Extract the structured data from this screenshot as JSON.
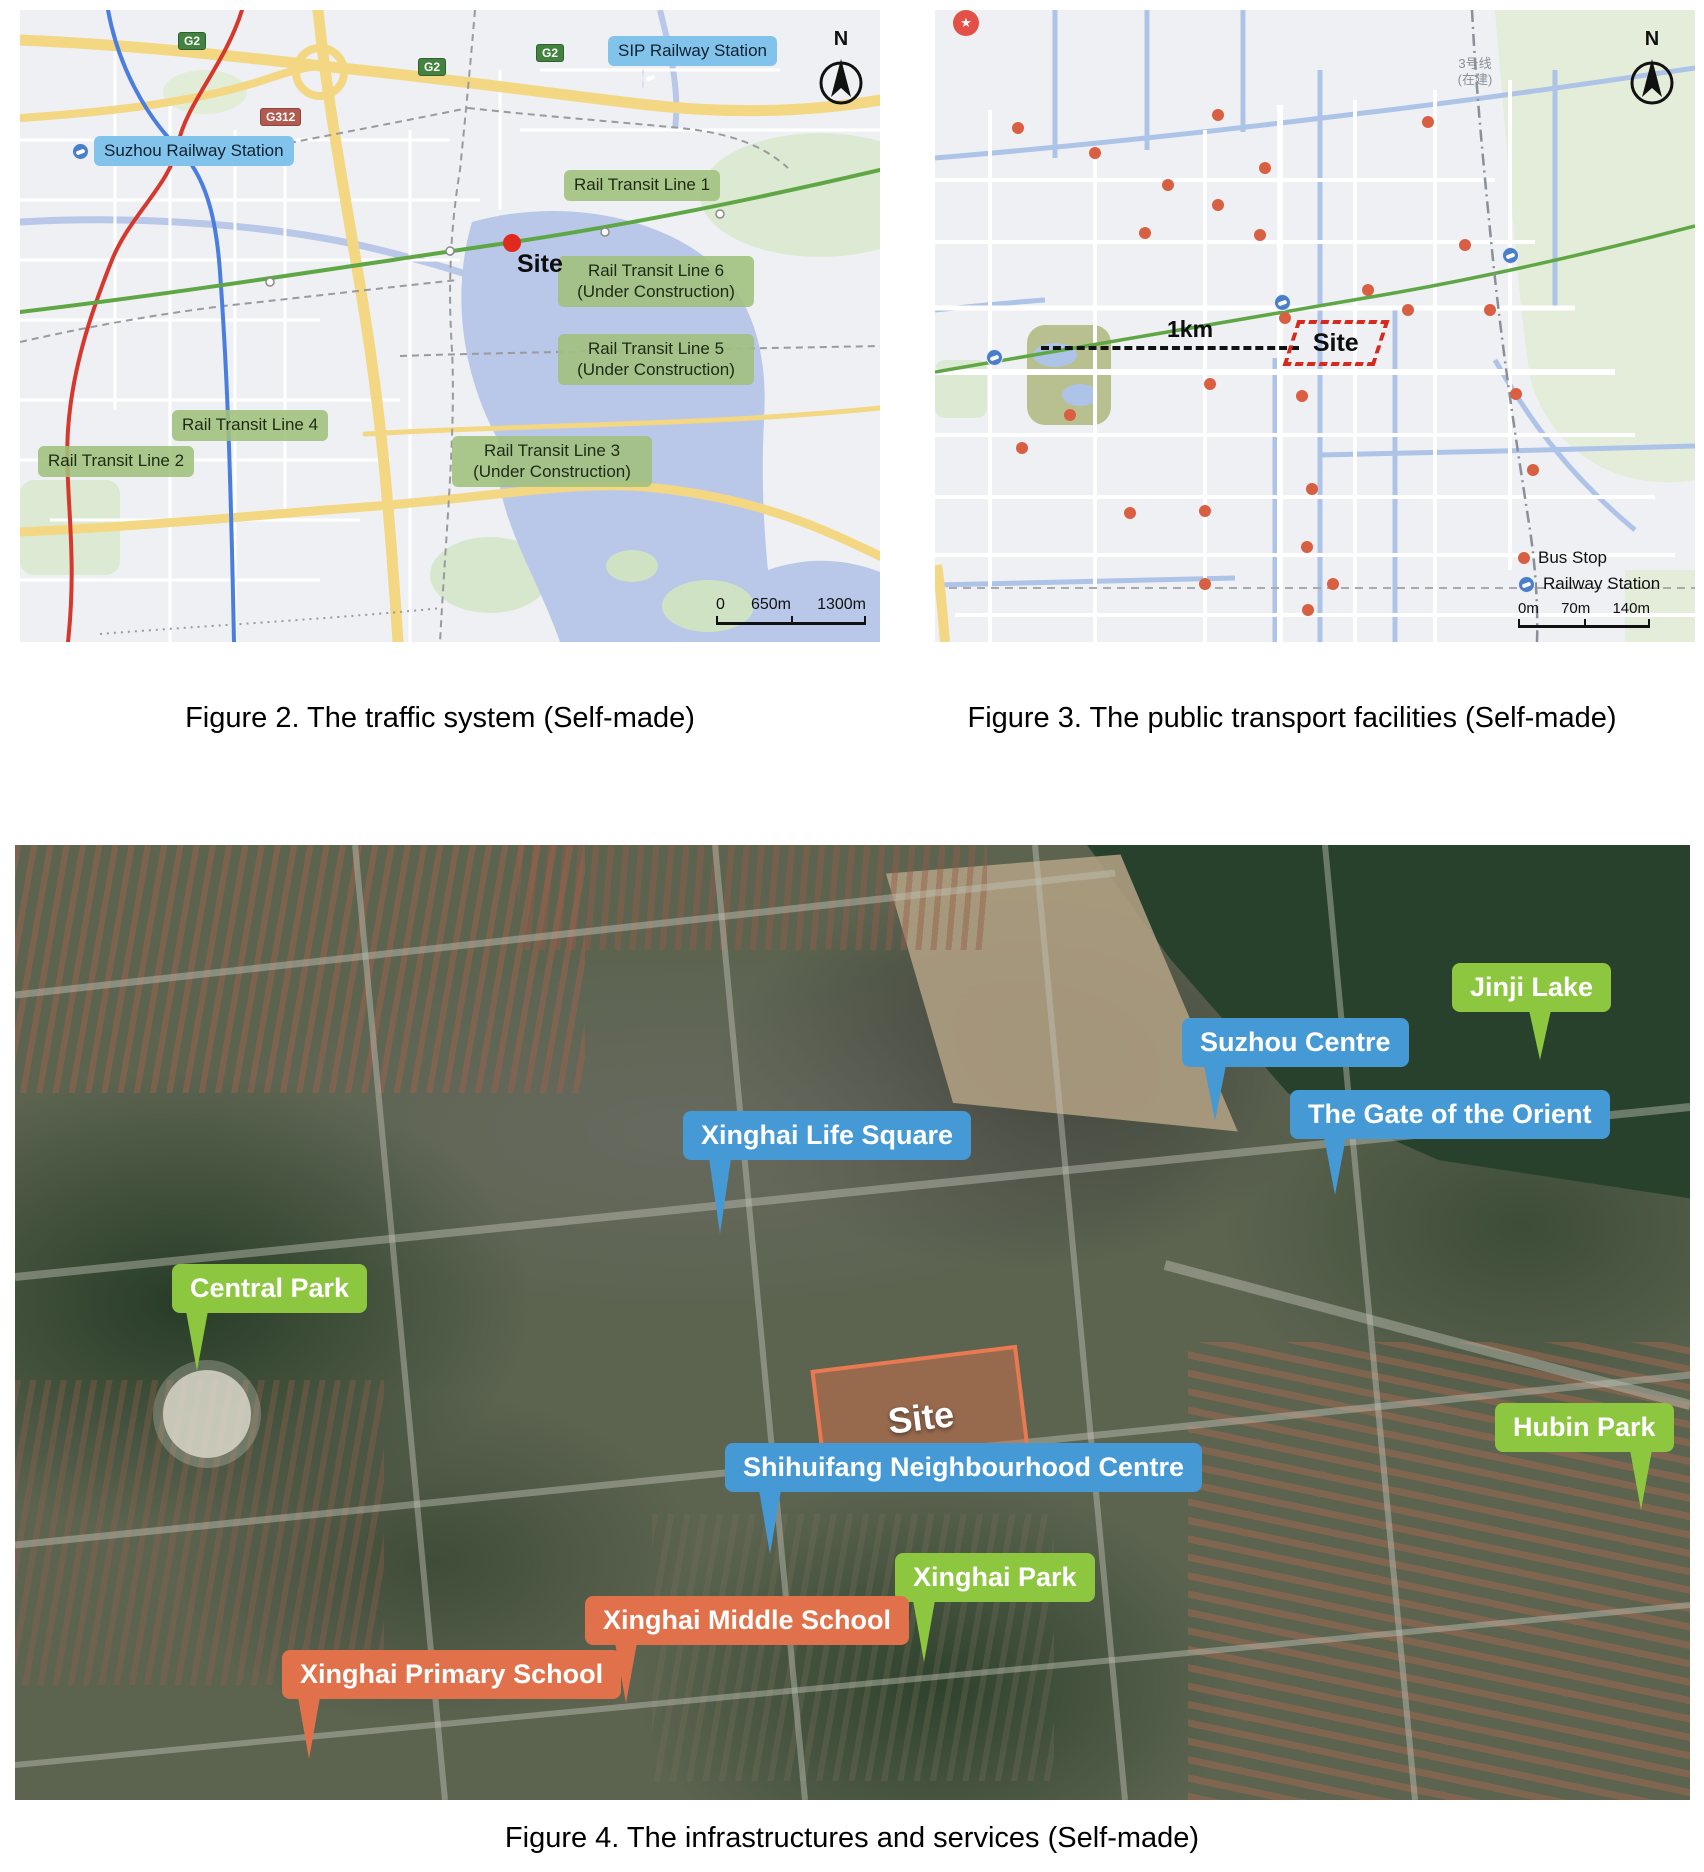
{
  "page": {
    "background": "#ffffff"
  },
  "figure2": {
    "caption": "Figure 2. The traffic system (Self-made)",
    "north_label": "N",
    "site_label": "Site",
    "station_labels": [
      {
        "text": "SIP Railway Station"
      },
      {
        "text": "Suzhou Railway Station"
      }
    ],
    "road_badges": [
      {
        "text": "G2"
      },
      {
        "text": "G2"
      },
      {
        "text": "G2"
      },
      {
        "text": "G312"
      }
    ],
    "line_labels": [
      {
        "text": "Rail Transit Line 1"
      },
      {
        "text": "Rail Transit Line 6\n(Under Construction)"
      },
      {
        "text": "Rail Transit Line 5\n(Under Construction)"
      },
      {
        "text": "Rail Transit Line 4"
      },
      {
        "text": "Rail Transit Line 2"
      },
      {
        "text": "Rail Transit Line 3\n(Under Construction)"
      }
    ],
    "scale_bar": {
      "labels": [
        "0",
        "650m",
        "1300m"
      ]
    }
  },
  "figure3": {
    "caption": "Figure 3. The public transport facilities (Self-made)",
    "north_label": "N",
    "site_label": "Site",
    "distance_label": "1km",
    "metro_line3_label": "3号线\n(在建)",
    "legend": {
      "bus_stop": "Bus Stop",
      "railway_station": "Railway Station"
    },
    "scale_bar": {
      "labels": [
        "0m",
        "70m",
        "140m"
      ]
    },
    "bus_stops": [
      [
        83,
        118
      ],
      [
        160,
        143
      ],
      [
        233,
        175
      ],
      [
        283,
        105
      ],
      [
        283,
        195
      ],
      [
        330,
        158
      ],
      [
        325,
        225
      ],
      [
        210,
        223
      ],
      [
        433,
        280
      ],
      [
        530,
        235
      ],
      [
        473,
        300
      ],
      [
        350,
        308
      ],
      [
        493,
        112
      ],
      [
        555,
        300
      ],
      [
        135,
        405
      ],
      [
        275,
        374
      ],
      [
        367,
        386
      ],
      [
        377,
        479
      ],
      [
        195,
        503
      ],
      [
        270,
        501
      ],
      [
        372,
        537
      ],
      [
        270,
        574
      ],
      [
        373,
        600
      ],
      [
        398,
        574
      ],
      [
        581,
        384
      ],
      [
        598,
        460
      ],
      [
        87,
        438
      ]
    ],
    "railway_stations": [
      [
        60,
        348
      ],
      [
        348,
        293
      ],
      [
        576,
        246
      ]
    ]
  },
  "figure4": {
    "caption": "Figure 4. The infrastructures and services (Self-made)",
    "site_label": "Site",
    "callouts": [
      {
        "label": "Jinji Lake",
        "color": "green"
      },
      {
        "label": "Suzhou Centre",
        "color": "blue"
      },
      {
        "label": "The Gate of the Orient",
        "color": "blue"
      },
      {
        "label": "Xinghai Life Square",
        "color": "blue"
      },
      {
        "label": "Central Park",
        "color": "green"
      },
      {
        "label": "Shihuifang Neighbourhood Centre",
        "color": "blue"
      },
      {
        "label": "Hubin Park",
        "color": "green"
      },
      {
        "label": "Xinghai Park",
        "color": "green"
      },
      {
        "label": "Xinghai Middle School",
        "color": "orange"
      },
      {
        "label": "Xinghai Primary School",
        "color": "orange"
      }
    ]
  },
  "colors": {
    "rail_line_green": "#5ea744",
    "rail_line_red": "#d6382e",
    "rail_line_blue": "#4a7de0",
    "highway_yellow": "#f3d782",
    "water_blue": "#b9c7e8",
    "transit_label_green_bg": "#a0c07c",
    "station_label_blue_bg": "#82c3ec",
    "bus_stop_red": "#d95f43",
    "coverage_circle_pink": "rgba(213,133,126,0.32)",
    "site_red": "#d42a20",
    "callout_blue": "#4599d4",
    "callout_green": "#8dc63f",
    "callout_orange": "#e0714b"
  }
}
